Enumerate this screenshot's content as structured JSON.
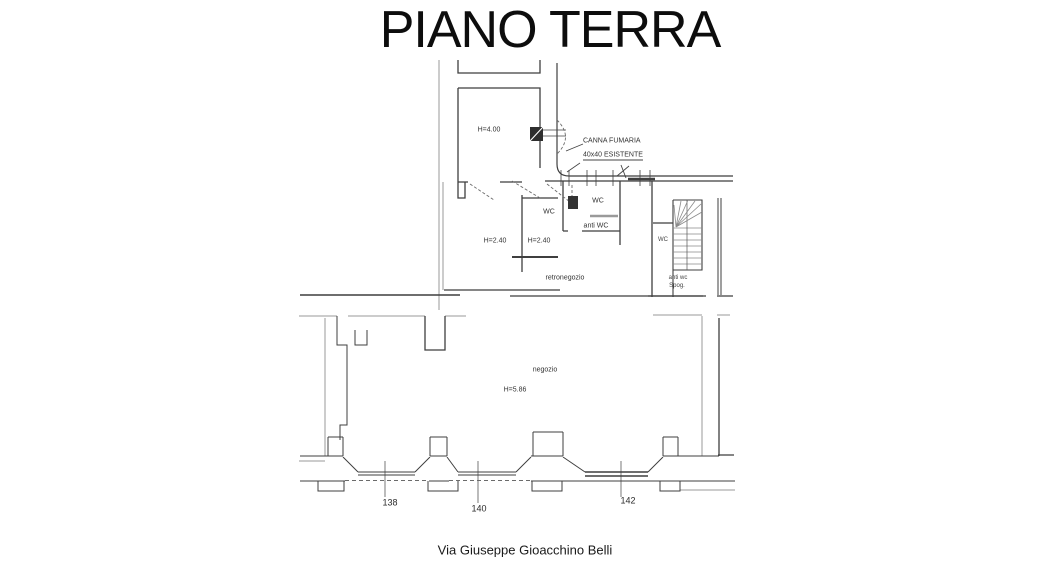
{
  "title": "PIANO TERRA",
  "plan": {
    "labels": {
      "h_main": "H=4.00",
      "flue_line1": "CANNA FUMARIA",
      "flue_line2": "40x40 ESISTENTE",
      "wc_back": "WC",
      "wc_mid": "WC",
      "anti_wc": "anti WC",
      "h_back_left": "H=2.40",
      "h_back_right": "H=2.40",
      "retronegozio": "retronegozio",
      "wc_stairs": "WC",
      "spogliatoio_line1": "anti wc",
      "spogliatoio_line2": "Spog.",
      "negozio": "negozio",
      "h_negozio": "H=5.86"
    },
    "street": {
      "numbers": [
        "138",
        "140",
        "142"
      ],
      "name": "Via Giuseppe Gioacchino Belli"
    }
  },
  "colors": {
    "wall_dark": "#3f3f3f",
    "wall_light": "#9a9a9a",
    "text": "#2b2b2b",
    "background": "#ffffff"
  }
}
